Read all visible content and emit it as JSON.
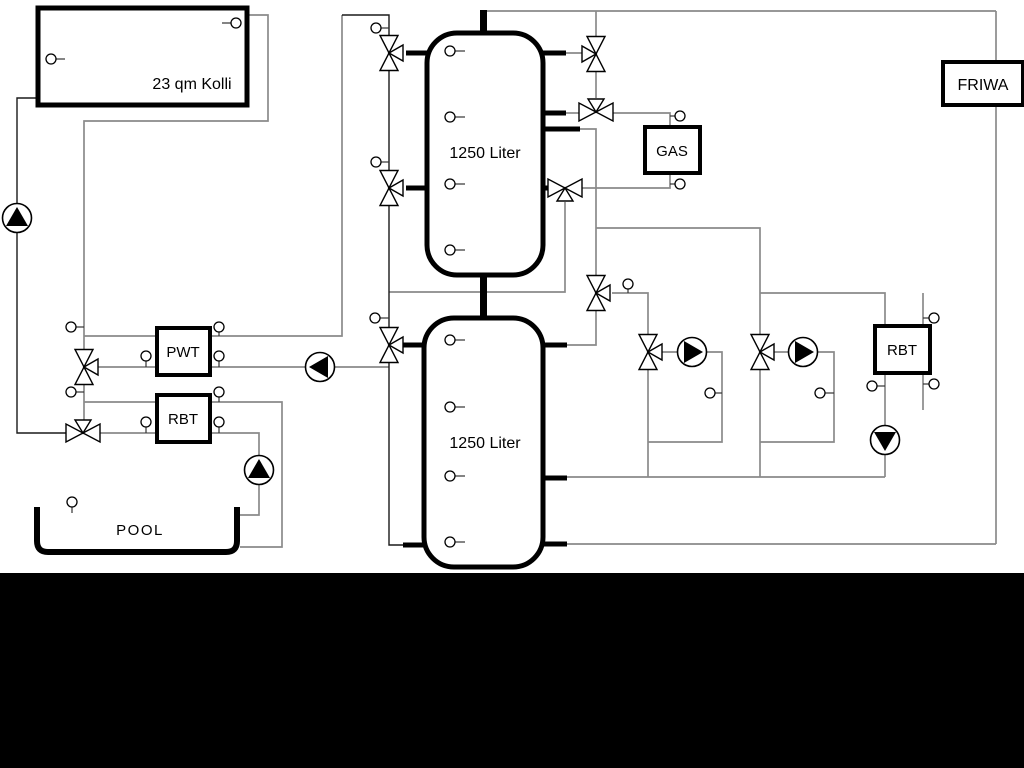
{
  "diagram": {
    "labels": {
      "collector": "23 qm Kolli",
      "buffer_tank_top": "1250 Liter",
      "buffer_tank_bottom": "1250 Liter",
      "gas_boiler": "GAS",
      "friwa": "FRIWA",
      "pwt": "PWT",
      "rbt_pool": "RBT",
      "rbt_dhw": "RBT",
      "pool": "POOL"
    },
    "colors": {
      "background": "#ffffff",
      "footer_bar": "#000000",
      "component_stroke": "#000000",
      "pipe_gray": "#8a8a8a",
      "pipe_dark": "#1a1a1a"
    }
  }
}
